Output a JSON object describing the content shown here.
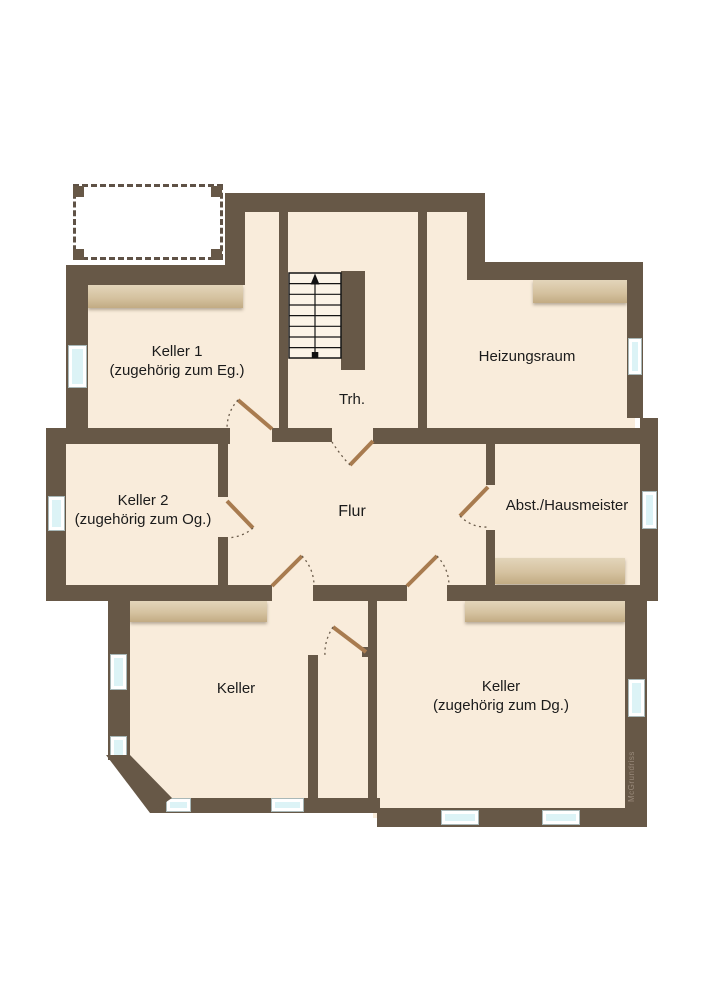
{
  "plan": {
    "rooms": {
      "keller1": {
        "label": "Keller 1",
        "sub": "(zugehörig zum Eg.)"
      },
      "trh": {
        "label": "Trh."
      },
      "heizungsraum": {
        "label": "Heizungsraum"
      },
      "keller2": {
        "label": "Keller 2",
        "sub": "(zugehörig zum Og.)"
      },
      "flur": {
        "label": "Flur"
      },
      "abst": {
        "label": "Abst./Hausmeister"
      },
      "keller": {
        "label": "Keller"
      },
      "keller_dg": {
        "label": "Keller",
        "sub": "(zugehörig zum Dg.)"
      }
    },
    "watermark": {
      "text": "McGrundriss"
    },
    "colors": {
      "wall": "#675847",
      "floor": "#f9ecdb",
      "wood_shelf": "#d5c2a0",
      "window_glass": "#dcf3f6",
      "door_leaf": "#a87b4f"
    },
    "features": {
      "doors": 7,
      "windows": 11,
      "stairs": {
        "steps": 8,
        "direction": "up"
      }
    }
  }
}
